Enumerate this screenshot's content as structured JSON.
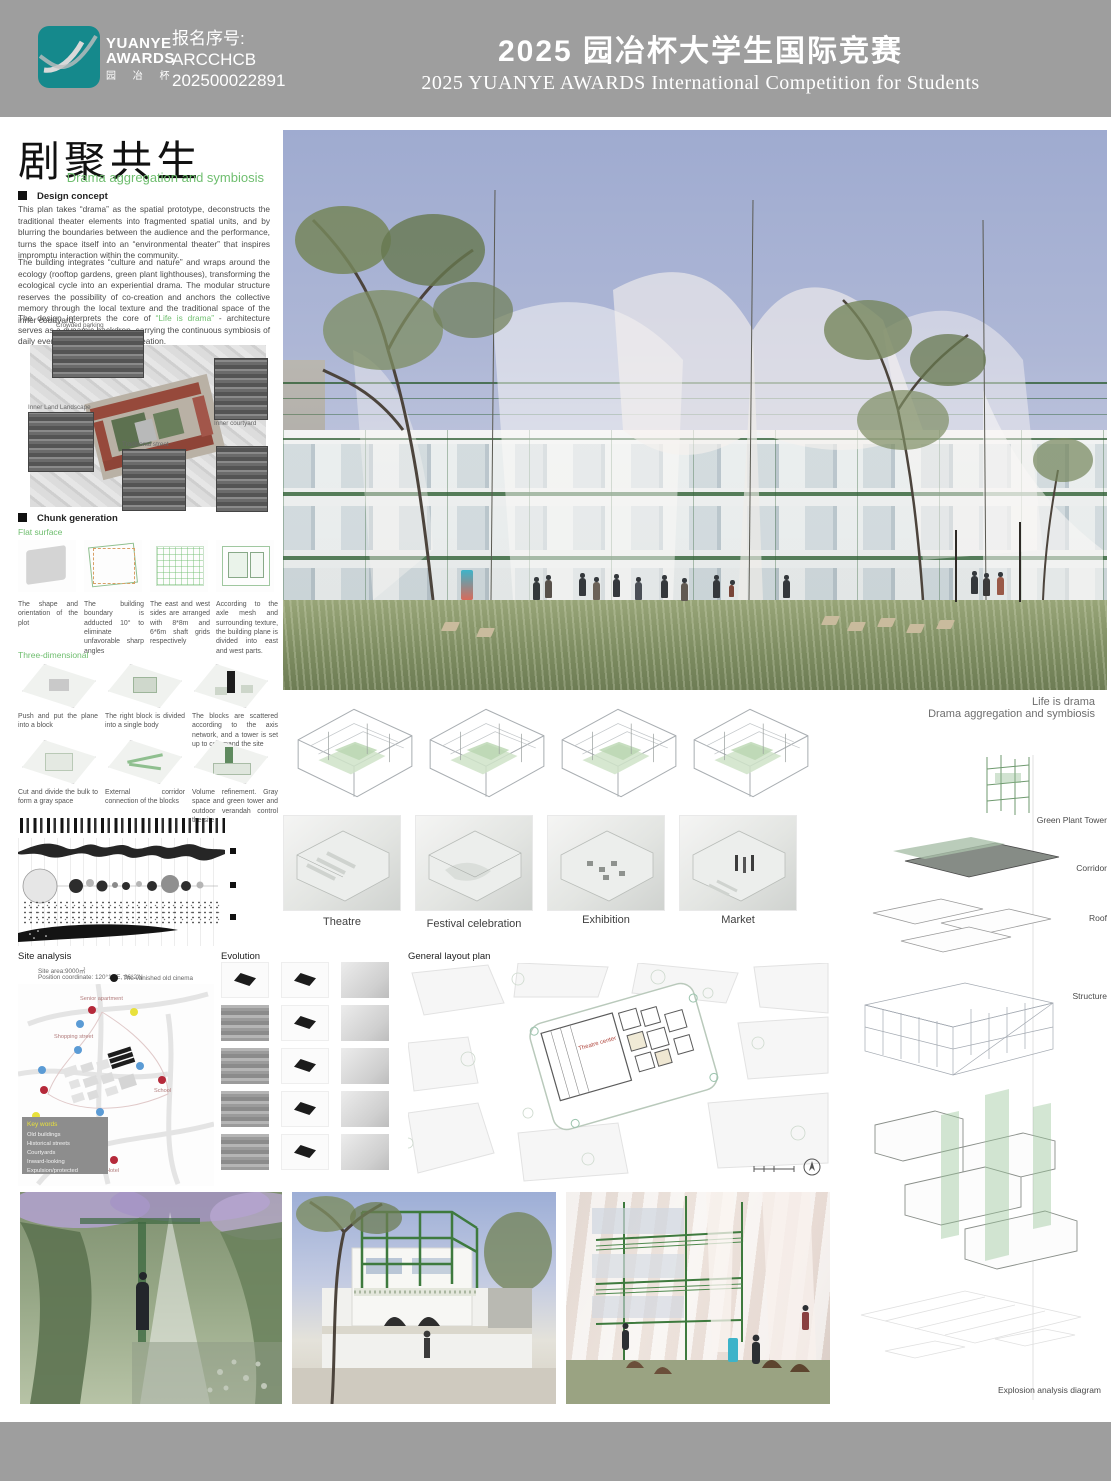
{
  "header": {
    "brand_line1": "YUANYE",
    "brand_line2": "AWARDS",
    "brand_cn": "园 冶 杯",
    "reg_label": "报名序号:",
    "reg_code": "ARCCHCB",
    "reg_number": "202500022891",
    "title_cn": "2025 园冶杯大学生国际竞赛",
    "title_en": "2025 YUANYE AWARDS International Competition for  Students"
  },
  "intro": {
    "title_cn": "剧聚共生",
    "subtitle": "Drama aggregation and symbiosis",
    "design_concept_heading": "Design concept",
    "p1": "This plan takes “drama” as the spatial prototype, deconstructs the traditional theater elements into fragmented spatial units, and by blurring the boundaries between the audience and the performance, turns the space itself into an “environmental theater” that inspires impromptu interaction within the community.",
    "p2": "The building integrates “culture and nature” and wraps around the ecology (rooftop gardens, green plant lighthouses), transforming the ecological cycle into an experiential drama. The modular structure reserves the possibility of co-creation and anchors the collective memory through the local texture and the traditional space of the inner courtyard.",
    "p3_before": "The design interprets the core of ",
    "p3_green": "“Life is drama”",
    "p3_after": " - architecture serves as a dynamic backdrop, carrying the continuous symbiosis of daily events and community co-creation."
  },
  "site_context": {
    "labels": [
      "Crowded parking",
      "Inner Land Landscape",
      "Inner courtyard",
      "Traditional street"
    ]
  },
  "chunk_generation": {
    "heading": "Chunk generation",
    "flat_surface": {
      "heading": "Flat surface",
      "steps": [
        "The shape and orientation of the plot",
        "The building boundary is adducted 10° to eliminate unfavorable sharp angles",
        "The east and west sides are arranged with 8*8m and 6*6m shaft grids respectively",
        "According to the axle mesh and surrounding texture, the building plane is divided into east and west parts."
      ]
    },
    "three_dimensional": {
      "heading": "Three-dimensional",
      "steps": [
        "Push and put the plane into a block",
        "The right block is divided into a single body",
        "The blocks are scattered according to the axis network, and a tower is set up to command the site",
        "Cut and divide the bulk to form a gray space",
        "External corridor connection of the blocks",
        "Volume refinement. Gray space and green tower and outdoor verandah control the site"
      ]
    }
  },
  "hero_caption": {
    "line1": "Life is drama",
    "line2": "Drama aggregation and symbiosis"
  },
  "scenarios": {
    "labels": [
      "Theatre",
      "Festival celebration",
      "Exhibition",
      "Market"
    ]
  },
  "site_analysis": {
    "heading": "Site analysis",
    "area": "Site area:9000㎡",
    "coordinates": "Position coordinate: 120°18′E, 36°2′N",
    "legend": [
      {
        "label": "The vanished old cinema",
        "color": "#1a1a1a"
      },
      {
        "label": "Building node",
        "color": "#b5293a"
      },
      {
        "label": "Subway station",
        "color": "#e8e13c"
      },
      {
        "label": "Bus stop",
        "color": "#5b9bd5"
      }
    ],
    "map_labels": {
      "senior_apartment": "Senior apartment",
      "shopping_street": "Shopping street",
      "school": "School",
      "shopping_mall": "Shopping mall",
      "hotel": "Hotel"
    },
    "keywords": {
      "title": "Key words",
      "items": [
        "Old buildings",
        "Historical streets",
        "Courtyards",
        "Inward-looking",
        "Expulsion/protected"
      ]
    }
  },
  "evolution": {
    "heading": "Evolution"
  },
  "layout_plan": {
    "heading": "General layout plan",
    "center_label": "Theatre center"
  },
  "explosion": {
    "labels": [
      "Green Plant Tower",
      "Corridor",
      "Roof",
      "Structure"
    ],
    "caption": "Explosion analysis diagram"
  },
  "colors": {
    "header_gray": "#9e9e9e",
    "logo_teal": "#15898c",
    "accent_green": "#6fbe6f",
    "frame_green": "#3e7a3e"
  }
}
